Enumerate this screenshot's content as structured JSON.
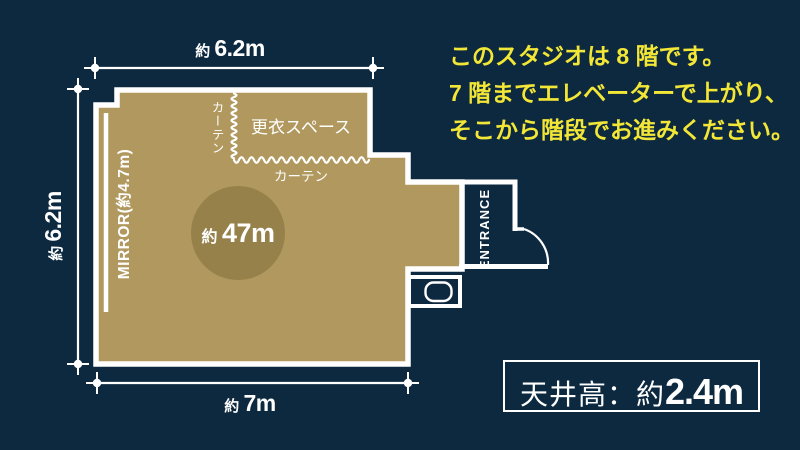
{
  "colors": {
    "background": "#0d2940",
    "floor": "#b0985e",
    "area_circle": "#97814b",
    "wall_line": "#ffffff",
    "notice_text": "#f2e636"
  },
  "floor_plan": {
    "dim_top": {
      "approx": "約 ",
      "value": "6.2m"
    },
    "dim_left": {
      "approx": "約 ",
      "value": "6.2m"
    },
    "dim_bottom": {
      "approx": "約 ",
      "value": "7m"
    },
    "mirror_label": "MIRROR(約4.7m)",
    "area": {
      "approx": "約 ",
      "value": "47m"
    },
    "changing_space": "更衣スペース",
    "curtain_vertical": "カーテン",
    "curtain_horizontal": "カーテン",
    "entrance": "ENTRANCE"
  },
  "notice": {
    "line1": "このスタジオは 8 階です。",
    "line2": "7 階までエレベーターで上がり、",
    "line3": "そこから階段でお進みください。"
  },
  "ceiling": {
    "label": "天井高：約",
    "value": "2.4m"
  }
}
